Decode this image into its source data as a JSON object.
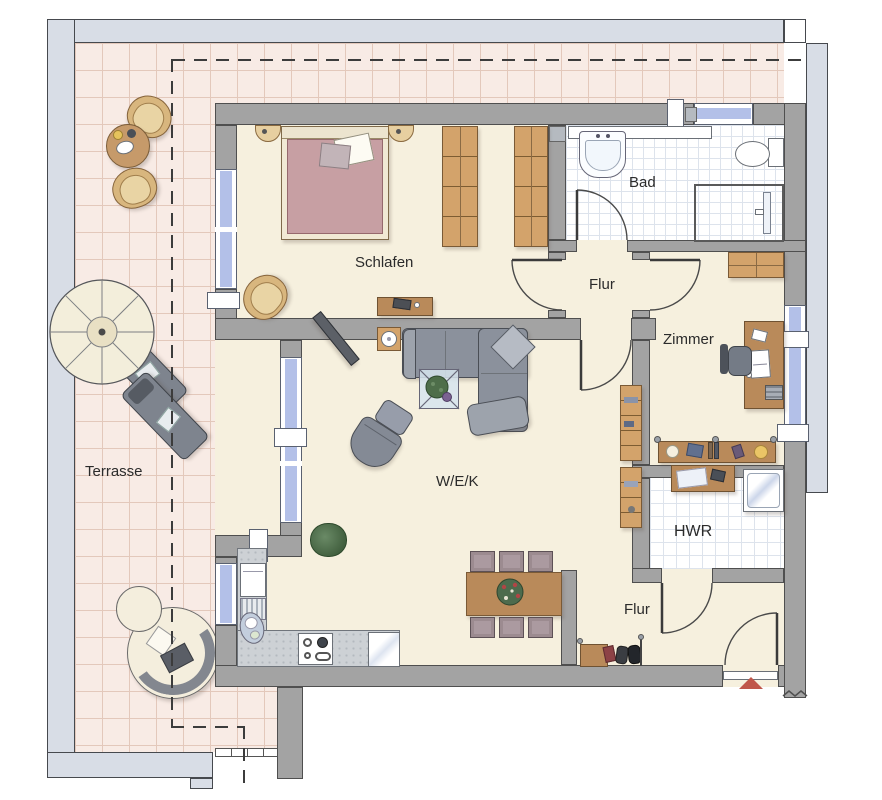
{
  "palette": {
    "wall": "#a3a3a3",
    "wall_outline": "#4f4f4f",
    "floor": "#f6f0de",
    "terrace_floor": "#f8ebe5",
    "terrace_grid": "#e3c8bb",
    "tile_grid": "#dde3ec",
    "outer_band": "#d8dde6",
    "window_glass": "#b3c0e8",
    "wood": "#d3a36b",
    "wood_dark": "#b98a5a",
    "sofa_gray": "#8b919c",
    "bed_mauve": "#c79fa3",
    "chair_mauve": "#9c8b90",
    "accent_red": "#c0564a",
    "label_text": "#2b2b2b"
  },
  "rooms": {
    "terrasse": {
      "label": "Terrasse"
    },
    "schlafen": {
      "label": "Schlafen"
    },
    "bad": {
      "label": "Bad"
    },
    "flur_oben": {
      "label": "Flur"
    },
    "zimmer": {
      "label": "Zimmer"
    },
    "wek": {
      "label": "W/E/K"
    },
    "hwr": {
      "label": "HWR"
    },
    "flur_unten": {
      "label": "Flur"
    }
  }
}
